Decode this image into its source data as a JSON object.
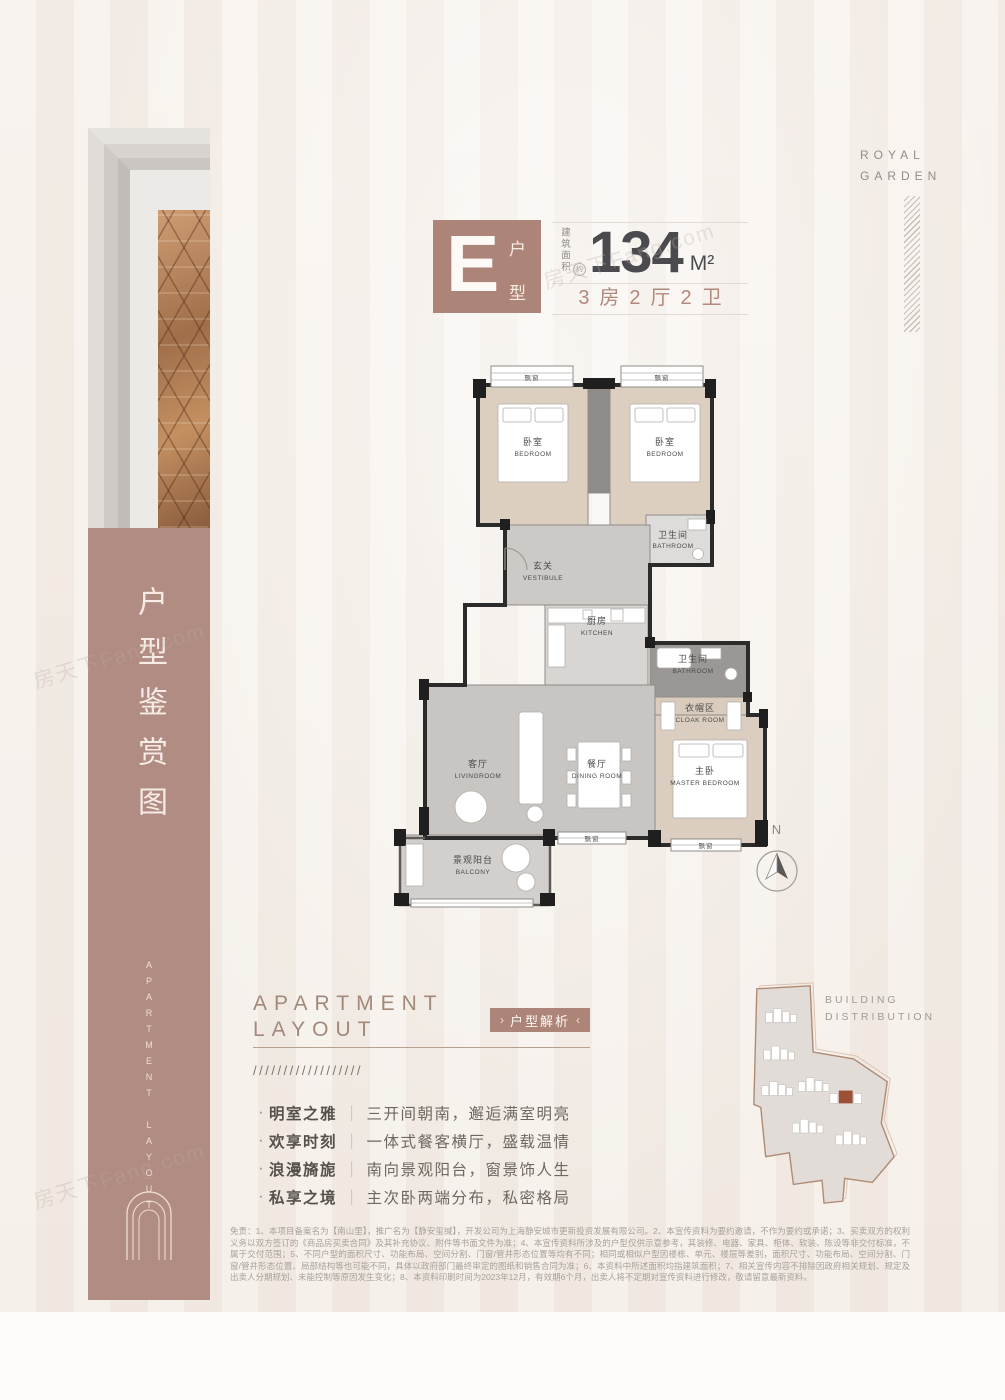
{
  "brand": {
    "line1": "ROYAL",
    "line2": "GARDEN"
  },
  "sidebar": {
    "title_cn": "户型鉴赏图",
    "title_en": "APARTMENT LAYOUT"
  },
  "header": {
    "type_letter": "E",
    "type_char_1": "户",
    "type_char_2": "型",
    "area_label": "建筑面积",
    "area_approx": "约",
    "area_value": "134",
    "area_unit": "M²",
    "spec": "3房2厅2卫"
  },
  "plan": {
    "window_label": "飘窗",
    "compass_n": "N",
    "rooms": {
      "bedroom_left": {
        "cn": "卧室",
        "en": "BEDROOM"
      },
      "bedroom_right": {
        "cn": "卧室",
        "en": "BEDROOM"
      },
      "bathroom_top": {
        "cn": "卫生间",
        "en": "BATHROOM"
      },
      "vestibule": {
        "cn": "玄关",
        "en": "VESTIBULE"
      },
      "kitchen": {
        "cn": "厨房",
        "en": "KITCHEN"
      },
      "bathroom_master": {
        "cn": "卫生间",
        "en": "BATHROOM"
      },
      "cloak": {
        "cn": "衣帽区",
        "en": "CLOAK ROOM"
      },
      "living": {
        "cn": "客厅",
        "en": "LIVINGROOM"
      },
      "dining": {
        "cn": "餐厅",
        "en": "DINING ROOM"
      },
      "master": {
        "cn": "主卧",
        "en": "MASTER BEDROOM"
      },
      "balcony": {
        "cn": "景观阳台",
        "en": "BALCONY"
      }
    }
  },
  "section": {
    "heading_line1": "APARTMENT",
    "heading_line2": "LAYOUT",
    "tag": "户型解析",
    "tag_open": "›",
    "tag_close": "‹",
    "slashes": "//////////////////",
    "bullet_dot": "·",
    "bullet_sep": "｜",
    "bullets": [
      {
        "title": "明室之雅",
        "desc": "三开间朝南，邂逅满室明亮"
      },
      {
        "title": "欢享时刻",
        "desc": "一体式餐客横厅，盛载温情"
      },
      {
        "title": "浪漫旖旎",
        "desc": "南向景观阳台，窗景饰人生"
      },
      {
        "title": "私享之境",
        "desc": "主次卧两端分布，私密格局"
      }
    ]
  },
  "building": {
    "label_line1": "BUILDING",
    "label_line2": "DISTRIBUTION"
  },
  "watermark": "房天下Fang.com",
  "disclaimer": "免责：1、本项目备案名为【南山里】，推广名为【静安玺缄】，开发公司为上海静安城市更新投资发展有限公司。2、本宣传资料为要约邀请，不作为要约或承诺；3、买卖双方的权利义务以双方签订的《商品房买卖合同》及其补充协议、附件等书面文件为准；4、本宣传资料所涉及的户型仅供示意参考，其装修、电器、家具、柜体、软装、陈设等非交付标准，不属于交付范围；5、不同户型的面积尺寸、功能布局、空间分割、门窗/管井形态位置等均有不同；相同或相似户型因楼栋、单元、楼层等差别，面积尺寸、功能布局、空间分割、门窗/管井形态位置、局部结构等也可能不同，具体以政府部门最终审定的图纸和销售合同为准；6、本资料中所述面积均指建筑面积；7、相关宣传内容不排除因政府相关规划、规定及出卖人分期规划、未能控制等原因发生变化；8、本资料印刷时间为2023年12月，有效期6个月，出卖人将不定期对宣传资料进行修改，敬请留意最新资料。"
}
